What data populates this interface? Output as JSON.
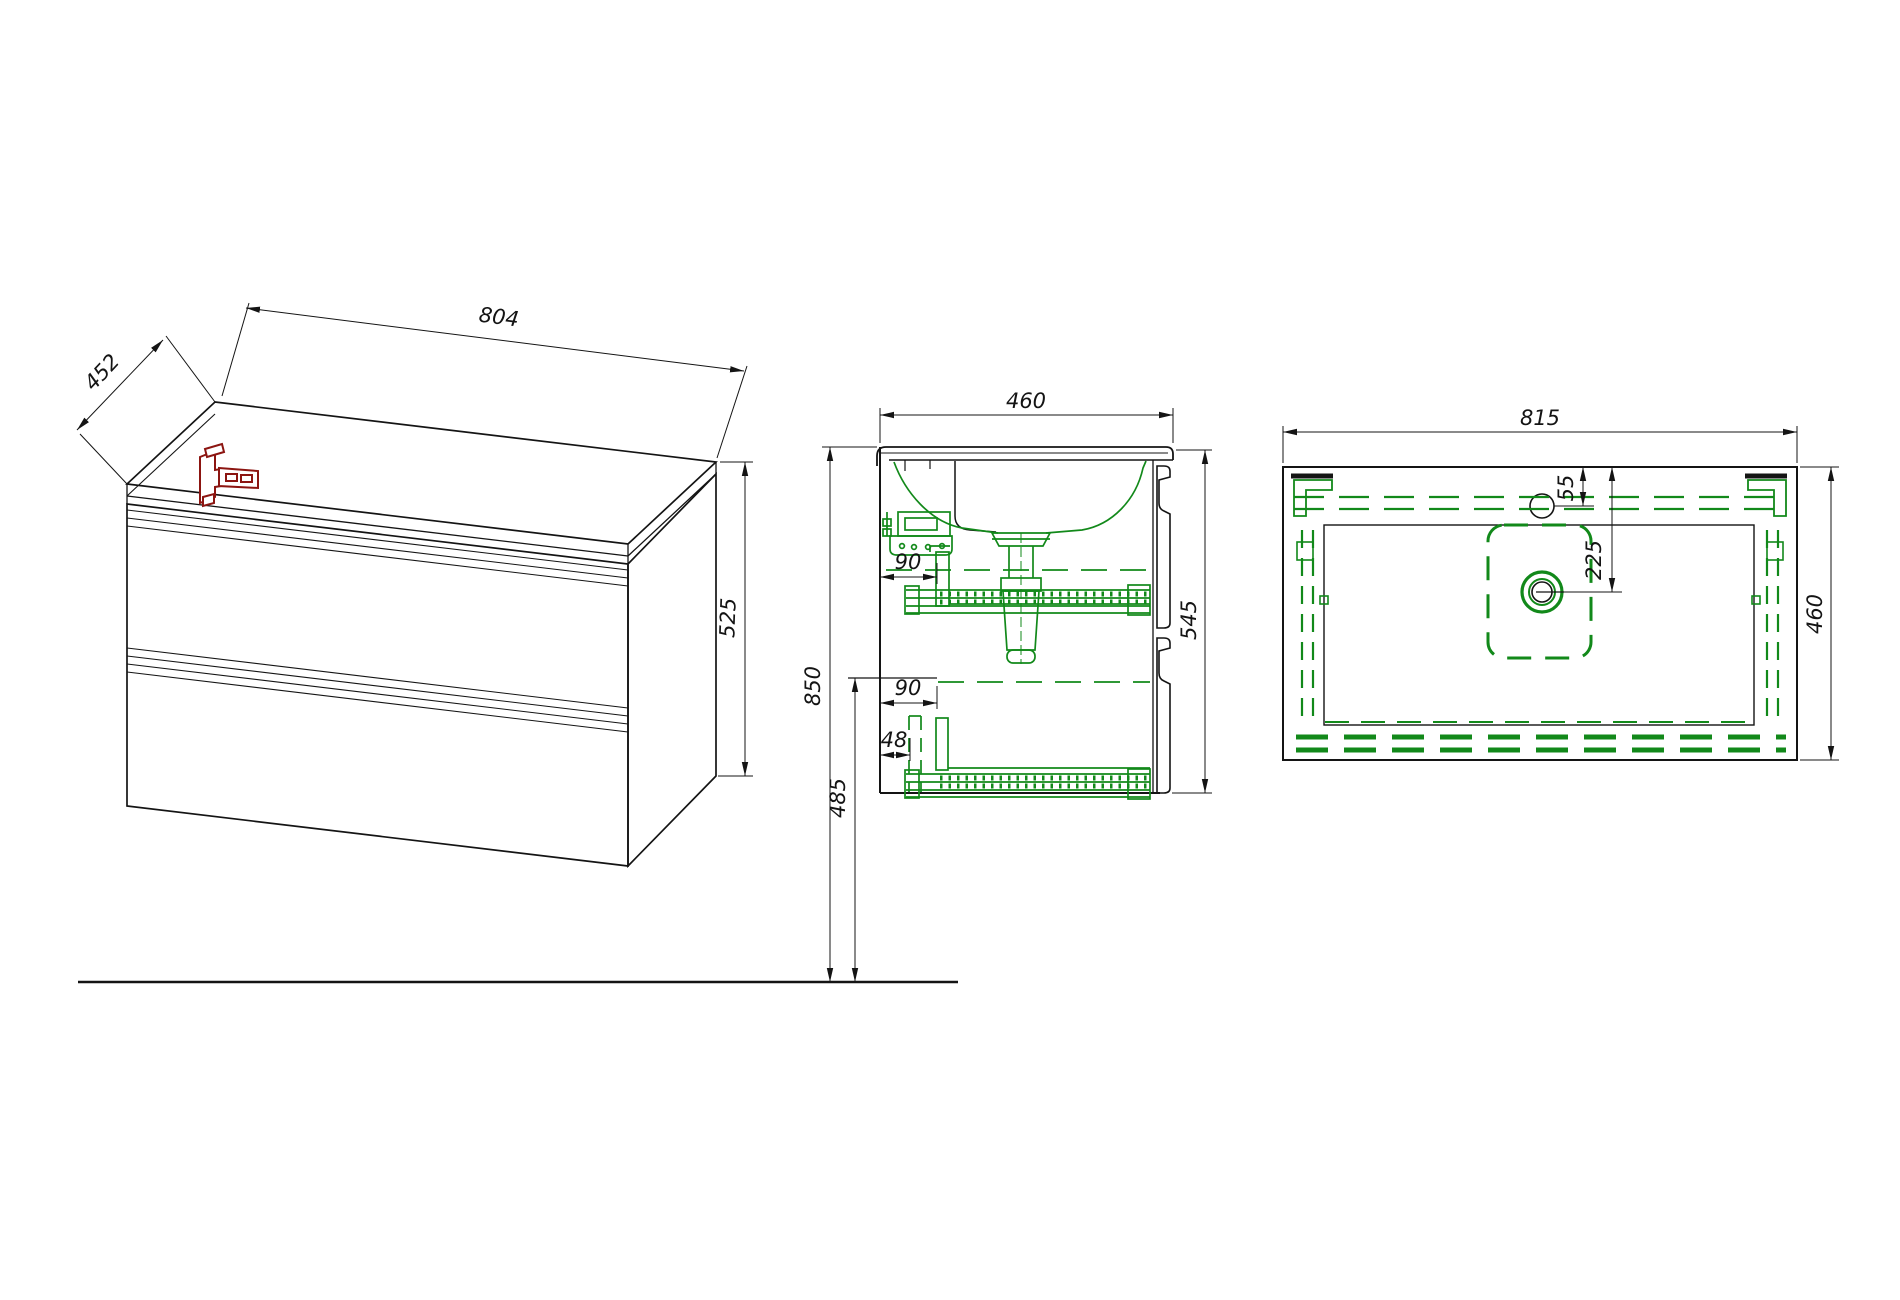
{
  "meta": {
    "drawing_type": "furniture technical drawing",
    "subject": "wall-hung vanity cabinet with basin",
    "background": "#ffffff",
    "line_color": "#141414",
    "hidden_hardware_color": "#12891a",
    "bracket_color": "#8c1511"
  },
  "views": {
    "isometric": {
      "label": "isometric view",
      "width": "804",
      "depth": "452",
      "height": "525"
    },
    "section": {
      "label": "side section view",
      "depth": "460",
      "height_front": "545",
      "height_wall": "850",
      "height_lower": "485",
      "offset_top": "90",
      "offset_mid": "90",
      "offset_bottom": "48"
    },
    "plan": {
      "label": "top view",
      "width": "815",
      "faucet_offset": "55",
      "drain_offset": "225",
      "depth": "460"
    }
  }
}
